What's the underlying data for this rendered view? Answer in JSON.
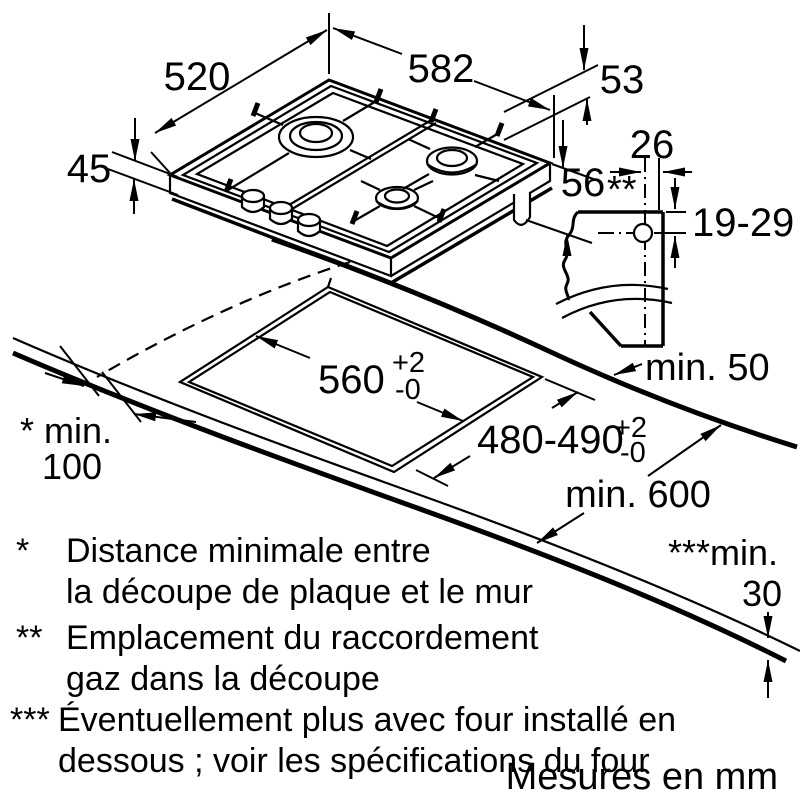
{
  "colors": {
    "line": "#000000",
    "burner_gray": "#c5c5c5",
    "burner_light": "#dadada"
  },
  "dimensions": {
    "depth": "520",
    "width": "582",
    "edge_offset": "53",
    "height_left": "45",
    "height_right": "56",
    "height_right_marker": "**",
    "gas_offset": "26",
    "gas_depth": "19-29",
    "rear_clearance": "min. 50",
    "worktop_depth": "min. 600",
    "cutout_width": {
      "value": "560",
      "plus": "+2",
      "minus": "-0"
    },
    "cutout_depth": {
      "value": "480-490",
      "plus": "+2",
      "minus": "-0"
    },
    "side_clearance_label": "* min.",
    "side_clearance_value": "100",
    "worktop_thickness_label": "***min.",
    "worktop_thickness_value": "30"
  },
  "footnotes": [
    {
      "marker": "*",
      "line1": "Distance minimale entre",
      "line2": "la découpe de plaque et le mur"
    },
    {
      "marker": "**",
      "line1": "Emplacement du raccordement",
      "line2": "gaz dans la découpe"
    },
    {
      "marker": "***",
      "line1": "Éventuellement plus avec four installé en",
      "line2": "dessous ; voir les spécifications du four"
    }
  ],
  "note": "Mesures en mm"
}
